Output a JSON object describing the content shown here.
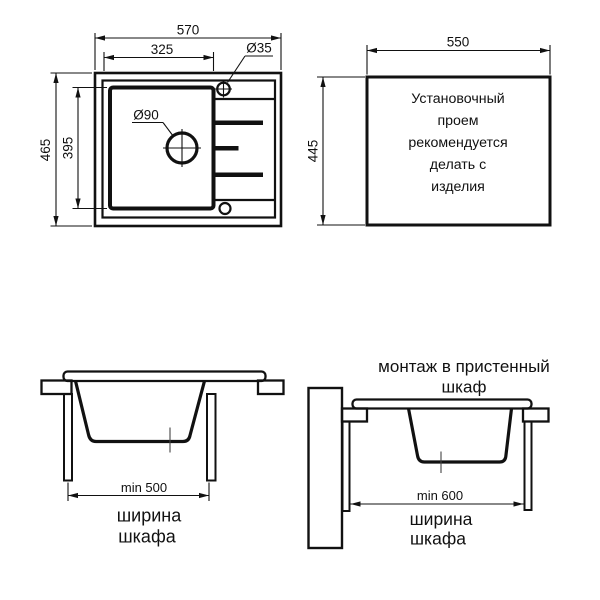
{
  "plan_view": {
    "dims": {
      "overall_width": "570",
      "bowl_width": "325",
      "tap_hole_diameter": "Ø35",
      "drain_diameter": "Ø90",
      "overall_depth": "465",
      "bowl_depth": "395"
    }
  },
  "cutout_view": {
    "dims": {
      "width": "550",
      "height": "445"
    },
    "note_lines": [
      "Установочный",
      "проем",
      "рекомендуется",
      "делать с",
      "изделия"
    ]
  },
  "section_standard": {
    "min_width_label": "min 500",
    "caption_line1": "ширина",
    "caption_line2": "шкафа"
  },
  "section_wall": {
    "title_line1": "монтаж в пристенный",
    "title_line2": "шкаф",
    "min_width_label": "min 600",
    "caption_line1": "ширина",
    "caption_line2": "шкафа"
  },
  "colors": {
    "line": "#111111",
    "background": "#ffffff"
  }
}
